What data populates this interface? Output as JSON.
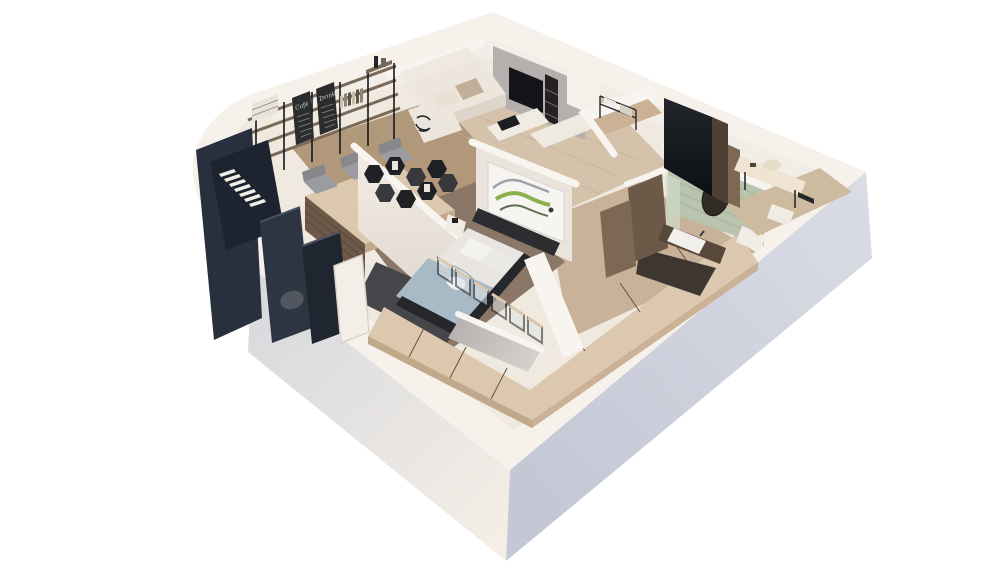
{
  "scene": {
    "title": "3D apartment floor plan cutaway render",
    "boards": {
      "cafe": "Café",
      "drinks": "Drinks"
    }
  },
  "palette": {
    "bg": "#ffffff",
    "shell_top": "#f6f2eb",
    "inner_plate": "#efe9e0",
    "inner_band": "#f2ede6",
    "cap_white": "#f8f5f0",
    "face_right_light": "#dadce5",
    "face_right_dark": "#c4c8d5",
    "face_left_gray": "#d9dade",
    "face_left_cream": "#f4eee6",
    "floor_office": "#b2987b",
    "floor_living": "#d5c2aa",
    "plank": "#c3ad92",
    "floor_hall": "#c9b29a",
    "floor_bed": "#8a7767",
    "rug": "#46454a",
    "navy_face": "#29303d",
    "navy_face2": "#2e3542",
    "navy_dark": "#1d2430",
    "navy_dark2": "#20262f",
    "navy_edge": "#4a5263",
    "tread": "#f1eee8",
    "door_white": "#f3efe8",
    "door_frame": "#d9d3c9",
    "pouf": "#52565e",
    "wall_face": "#eae4dc",
    "wall_face_light": "#f0eae2",
    "wall_face_shade": "#ddd5cb",
    "shelf_wood": "#7b6a58",
    "post_black": "#17181a",
    "board_bg": "#2a2c2e",
    "board_text": "#d8d3c6",
    "board_line": "#8a877c",
    "linen": "#e8e3d8",
    "book_a": "#c7bfae",
    "book_b": "#8d8478",
    "book_c": "#5b544a",
    "bottle_dark": "#23262a",
    "bottle_light": "#6d675e",
    "wood_top": "#dcc8ae",
    "wood_side": "#c2a88b",
    "wood_side2": "#cbb195",
    "wood_gap": "#6b5138",
    "walnut": "#6d5947",
    "walnut_light": "#7d6853",
    "walnut_dark": "#574839",
    "walnut_dark2": "#4e4034",
    "chair_back": "#87888b",
    "chair_seat": "#9b9c9f",
    "plant": "#35462f",
    "pot": "#23262b",
    "media_wall": "#b5b0ad",
    "tv": "#141519",
    "niche": "#232122",
    "niche_shelf": "#6b6663",
    "credenza": "#eee9e1",
    "column_white": "#f4f0ea",
    "sofa": "#efe9e1",
    "sofa_seat": "#ece6dd",
    "sofa_front": "#ddd5c9",
    "cushion_a": "#c2ad97",
    "cushion_b": "#e7e1d6",
    "stripe_dark": "#2b2c2e",
    "stripe_light": "#e9e6df",
    "coffee_table": "#f0ebe3",
    "tray": "#1e1f22",
    "hex_black": "#202124",
    "hex_face": "#37393d",
    "hex_book": "#e9e6df",
    "art_bg": "#f6f5f1",
    "art_border": "#d8d4ce",
    "art_green": "#8cb04c",
    "art_sage": "#5f6f52",
    "art_gray": "#9aa3aa",
    "art_dark": "#3a3d40",
    "headboard": "#2c2d31",
    "mattress": "#e8e5e2",
    "pillow_a": "#f4f2ef",
    "pillow_b": "#ebe9e6",
    "blanket": "#a9bac7",
    "blanket_fold": "#8fa5b4",
    "sheet": "#eef0f1",
    "bedframe": "#26272b",
    "nightstand": "#f0ebe4",
    "glass_frame": "#232428",
    "glass": "#dfe5e6",
    "gray_wall_a": "#b5b2b1",
    "gray_wall_b": "#d8d5d1",
    "green_wall": "#b9c3ae",
    "green_line": "#a6b19b",
    "mirror": "#322c27",
    "mirror_rim": "#241f1b",
    "sink": "#f2f0ec",
    "faucet": "#3a3c40",
    "bath_floor": "#3e3731",
    "glass_green": "#cedbc5",
    "niche_white": "#f1ece4",
    "counter": "#efe3d1",
    "hat_box": "#e7dcc6",
    "leg_black": "#2a2b2e",
    "dressing_floor": "#cdbb9f",
    "pedestal": "#f0ebe3",
    "panel_top": "#22262c",
    "panel_bottom": "#0d0f12",
    "metal": "#26282c",
    "towel": "#eceae4",
    "box2": "#d9d2c4"
  }
}
